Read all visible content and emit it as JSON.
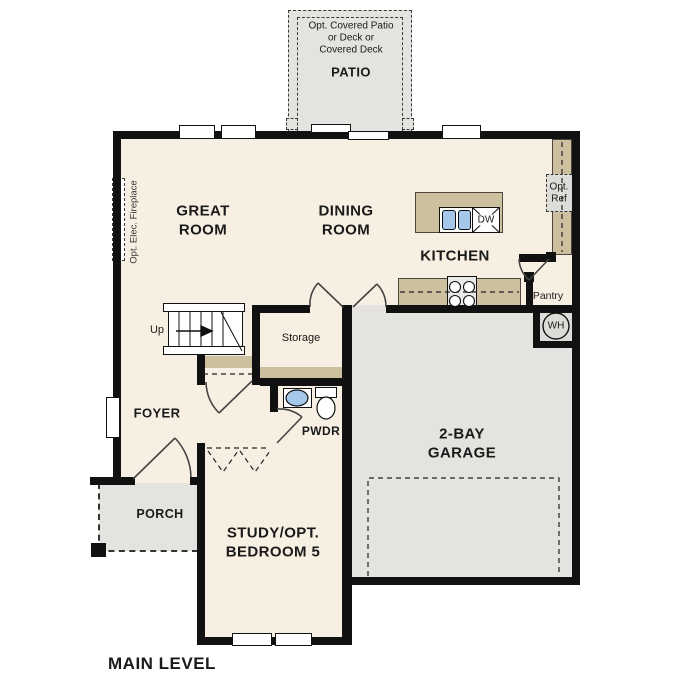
{
  "title": "MAIN LEVEL",
  "colors": {
    "floor": "#f7efe2",
    "outdoor": "#e4e3e0",
    "counter": "#cdc09f",
    "wall": "#111111",
    "fixture_blue": "#a5c7e9",
    "appliance_gray": "#dcdcd9"
  },
  "rooms": {
    "patio": {
      "label": "PATIO",
      "note": [
        "Opt. Covered Patio",
        "or Deck or",
        "Covered Deck"
      ]
    },
    "great_room": {
      "lines": [
        "GREAT",
        "ROOM"
      ]
    },
    "dining_room": {
      "lines": [
        "DINING",
        "ROOM"
      ]
    },
    "kitchen": {
      "label": "KITCHEN"
    },
    "pantry": {
      "label": "Pantry"
    },
    "storage": {
      "label": "Storage"
    },
    "foyer": {
      "label": "FOYER"
    },
    "powder_room": {
      "label": "PWDR"
    },
    "porch": {
      "label": "PORCH"
    },
    "garage": {
      "lines": [
        "2-BAY",
        "GARAGE"
      ]
    },
    "study": {
      "lines": [
        "STUDY/OPT.",
        "BEDROOM 5"
      ]
    }
  },
  "annotations": {
    "stairs_direction": "Up",
    "water_heater": "WH",
    "dishwasher": "DW",
    "opt_refrigerator": [
      "Opt.",
      "Ref"
    ],
    "opt_fireplace": "Opt. Elec. Fireplace"
  }
}
